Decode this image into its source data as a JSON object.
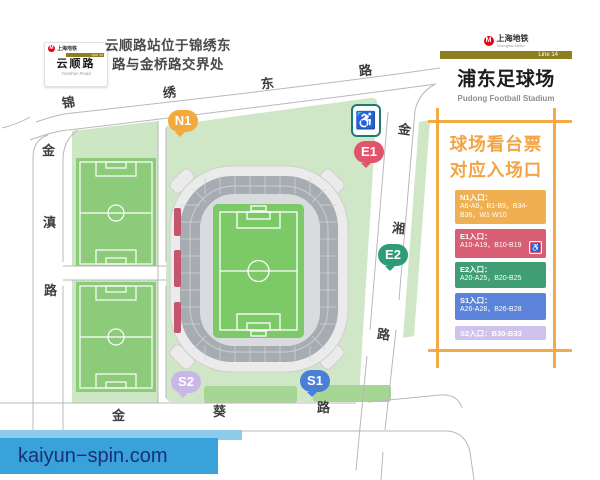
{
  "station_sign": {
    "logo_text": "上海地铁",
    "line_label": "Line 14",
    "name_cn": "云顺路",
    "name_en": "Yunshun Road"
  },
  "note": {
    "line1": "云顺路站位于锦绣东",
    "line2": "路与金桥路交界处"
  },
  "header": {
    "logo_text": "上海地铁",
    "logo_sub": "Shanghai Metro",
    "line_label": "Line 14",
    "title_cn": "浦东足球场",
    "title_en": "Pudong Football Stadium"
  },
  "roads": {
    "jinxiu_east": {
      "name": "锦绣东路",
      "chars": [
        "锦",
        "绣",
        "东",
        "路"
      ]
    },
    "jindian": {
      "name": "金滇路",
      "chars": [
        "金",
        "滇",
        "路"
      ]
    },
    "jinkui": {
      "name": "金葵路",
      "chars": [
        "金",
        "葵",
        "路"
      ]
    },
    "jinxiang": {
      "name": "金湘路",
      "chars": [
        "金",
        "湘",
        "路"
      ]
    }
  },
  "gates": [
    {
      "id": "N1",
      "label": "N1",
      "color": "#f3a93c"
    },
    {
      "id": "E1",
      "label": "E1",
      "color": "#e2536c"
    },
    {
      "id": "E2",
      "label": "E2",
      "color": "#2e9c74"
    },
    {
      "id": "S1",
      "label": "S1",
      "color": "#4a7fd9"
    },
    {
      "id": "S2",
      "label": "S2",
      "color": "#c9b7e8"
    }
  ],
  "icons": {
    "map_accessible_entrance": "wheelchair",
    "legend_e1_accessible": "wheelchair"
  },
  "legend": {
    "title_line1": "球场看台票",
    "title_line2": "对应入场口",
    "frame_color": "#f3ab45",
    "title_color": "#f2a444",
    "blocks": [
      {
        "entrance": "N1",
        "color": "#f0b052",
        "lines": [
          "N1入口：",
          "A6-A9，B1-B9，B34-",
          "B36，W1-W10"
        ]
      },
      {
        "entrance": "E1",
        "color": "#d95d73",
        "lines": [
          "E1入口：",
          "A10-A19，B10-B19"
        ]
      },
      {
        "entrance": "E2",
        "color": "#3f9e74",
        "lines": [
          "E2入口：",
          "A20-A25，B20-B25"
        ]
      },
      {
        "entrance": "S1",
        "color": "#5b83d9",
        "lines": [
          "S1入口：",
          "A26-A28，B26-B28"
        ]
      },
      {
        "entrance": "S2",
        "color": "#cfc2ec",
        "lines": [
          "S2入口：B30-B33"
        ]
      }
    ]
  },
  "watermark": {
    "text": "kaiyun−spin.com",
    "color": "#39a2db"
  },
  "map_colors": {
    "green_area": "#cfe7c6",
    "pitch_green": "#7cc968",
    "stadium_shell": "#ebebeb",
    "seating_ring": "#a7acb2",
    "west_strip_red": "#c4556d",
    "metro_red": "#e60012",
    "line_bar_olive": "#8b7f1f"
  }
}
